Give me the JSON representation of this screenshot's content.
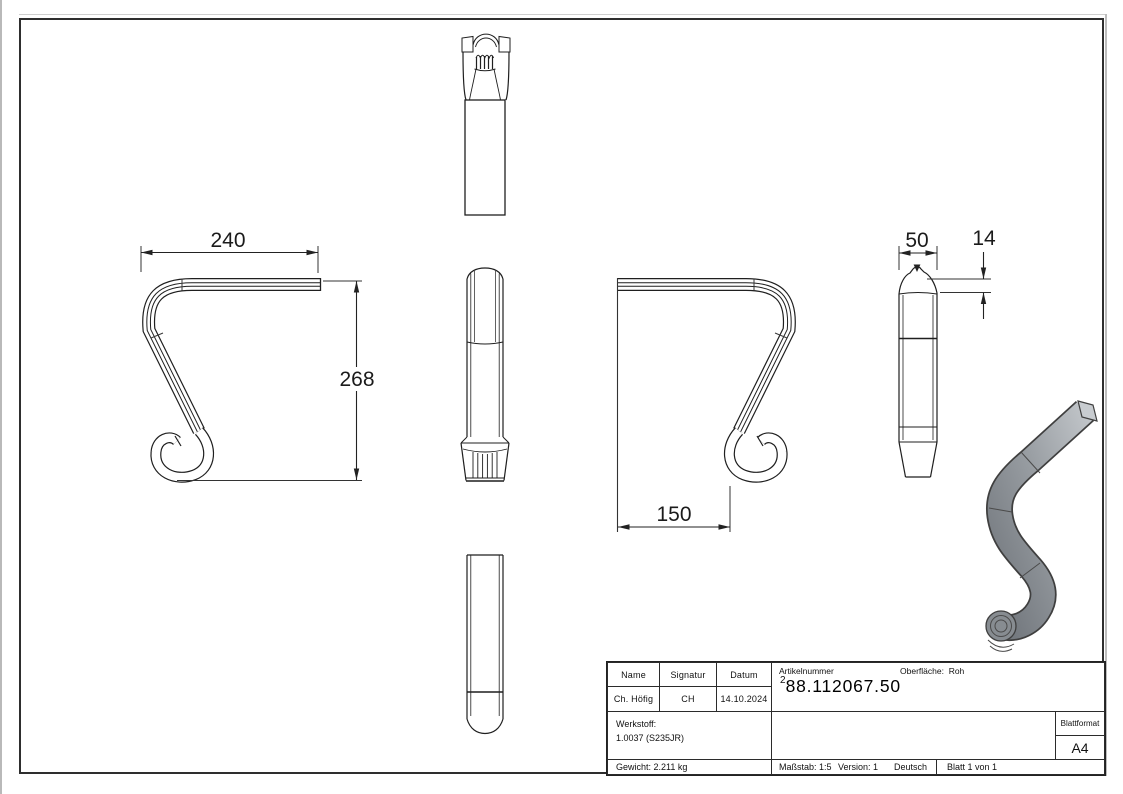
{
  "dims": {
    "w240": "240",
    "h268": "268",
    "w150": "150",
    "w50": "50",
    "h14": "14"
  },
  "title_block": {
    "name_header": "Name",
    "signature_header": "Signatur",
    "date_header": "Datum",
    "name_value": "Ch. Höfig",
    "signature_value": "CH",
    "date_value": "14.10.2024",
    "article_label": "Artikelnummer",
    "article_prefix": "2",
    "article_number": "88.112067.50",
    "surface_label": "Oberfläche:",
    "surface_value": "Roh",
    "material_label": "Werkstoff:",
    "material_value": "1.0037 (S235JR)",
    "weight": "Gewicht: 2.211 kg",
    "scale": "Maßstab: 1:5",
    "version": "Version: 1",
    "language": "Deutsch",
    "sheet": "Blatt 1 von 1",
    "format_label": "Blattformat",
    "format_value": "A4"
  }
}
